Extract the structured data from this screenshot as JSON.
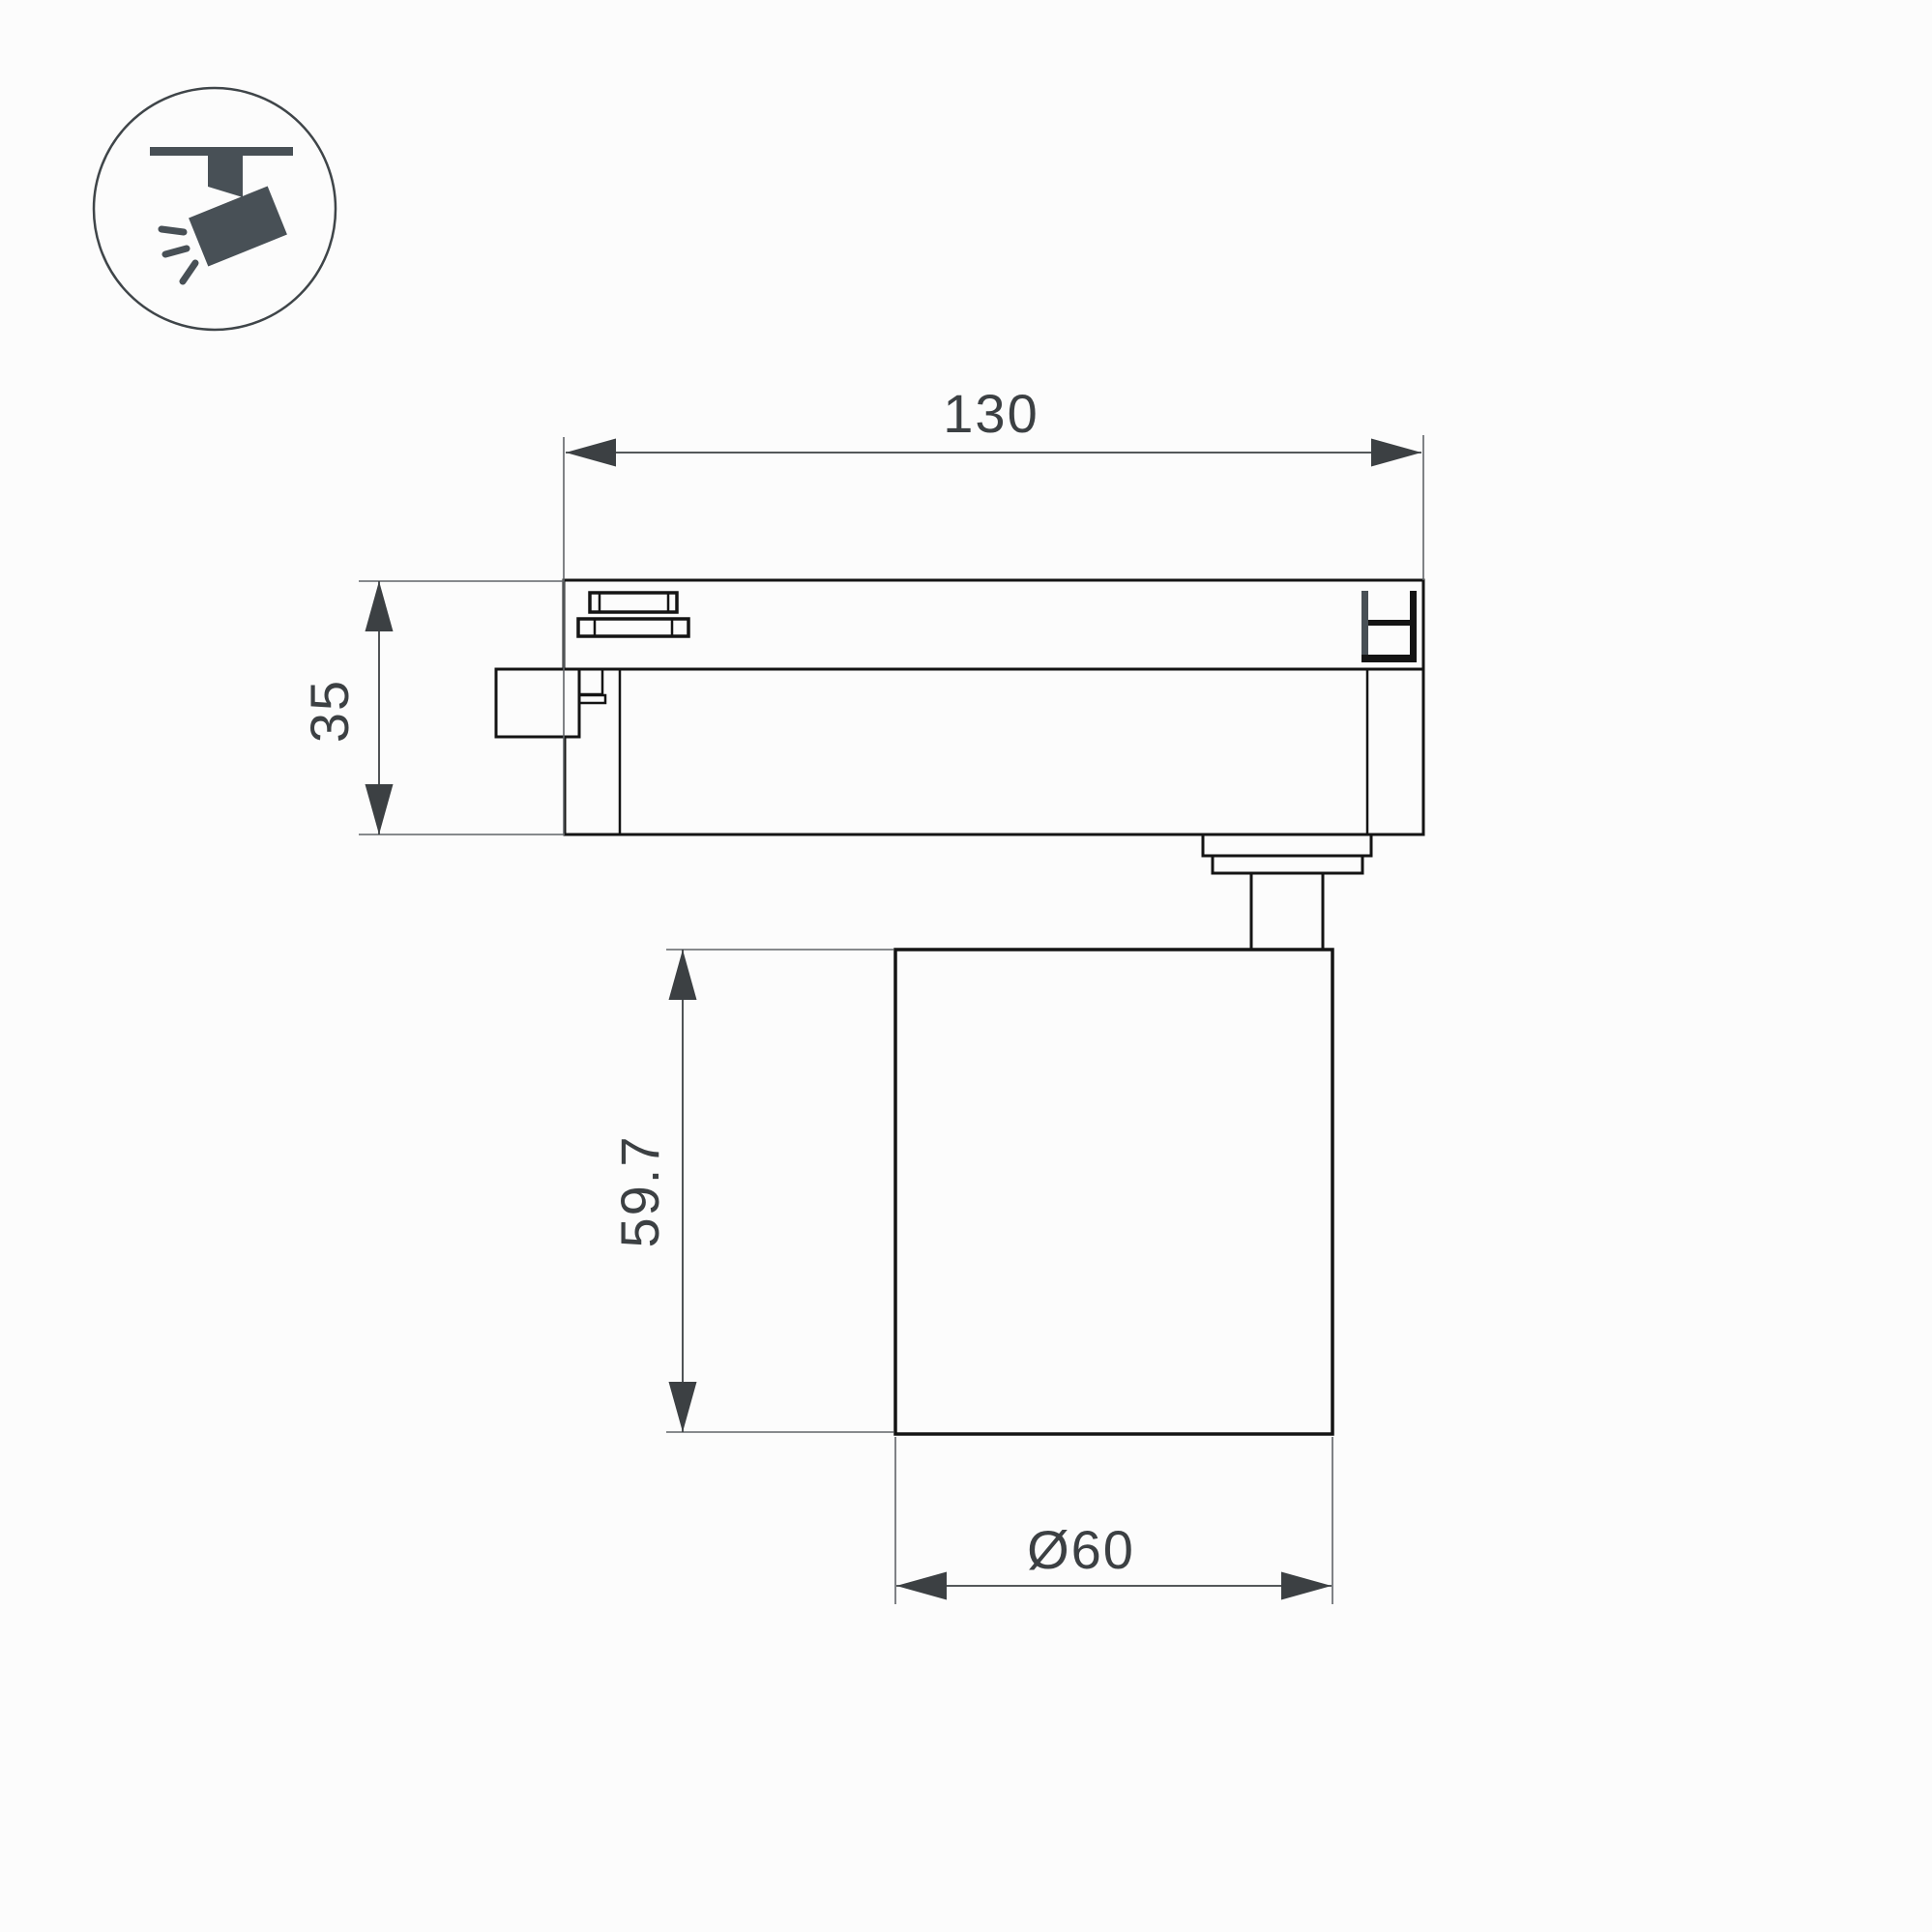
{
  "colors": {
    "line": "#141414",
    "dimension": "#3c4043",
    "extension": "#606468",
    "icon": "#485056",
    "background": "#fcfcfc"
  },
  "icon": {
    "name": "track-spotlight-icon"
  },
  "dimensions": {
    "width": "130",
    "track_height": "35",
    "body_height": "59.7",
    "diameter": "Ø60"
  }
}
